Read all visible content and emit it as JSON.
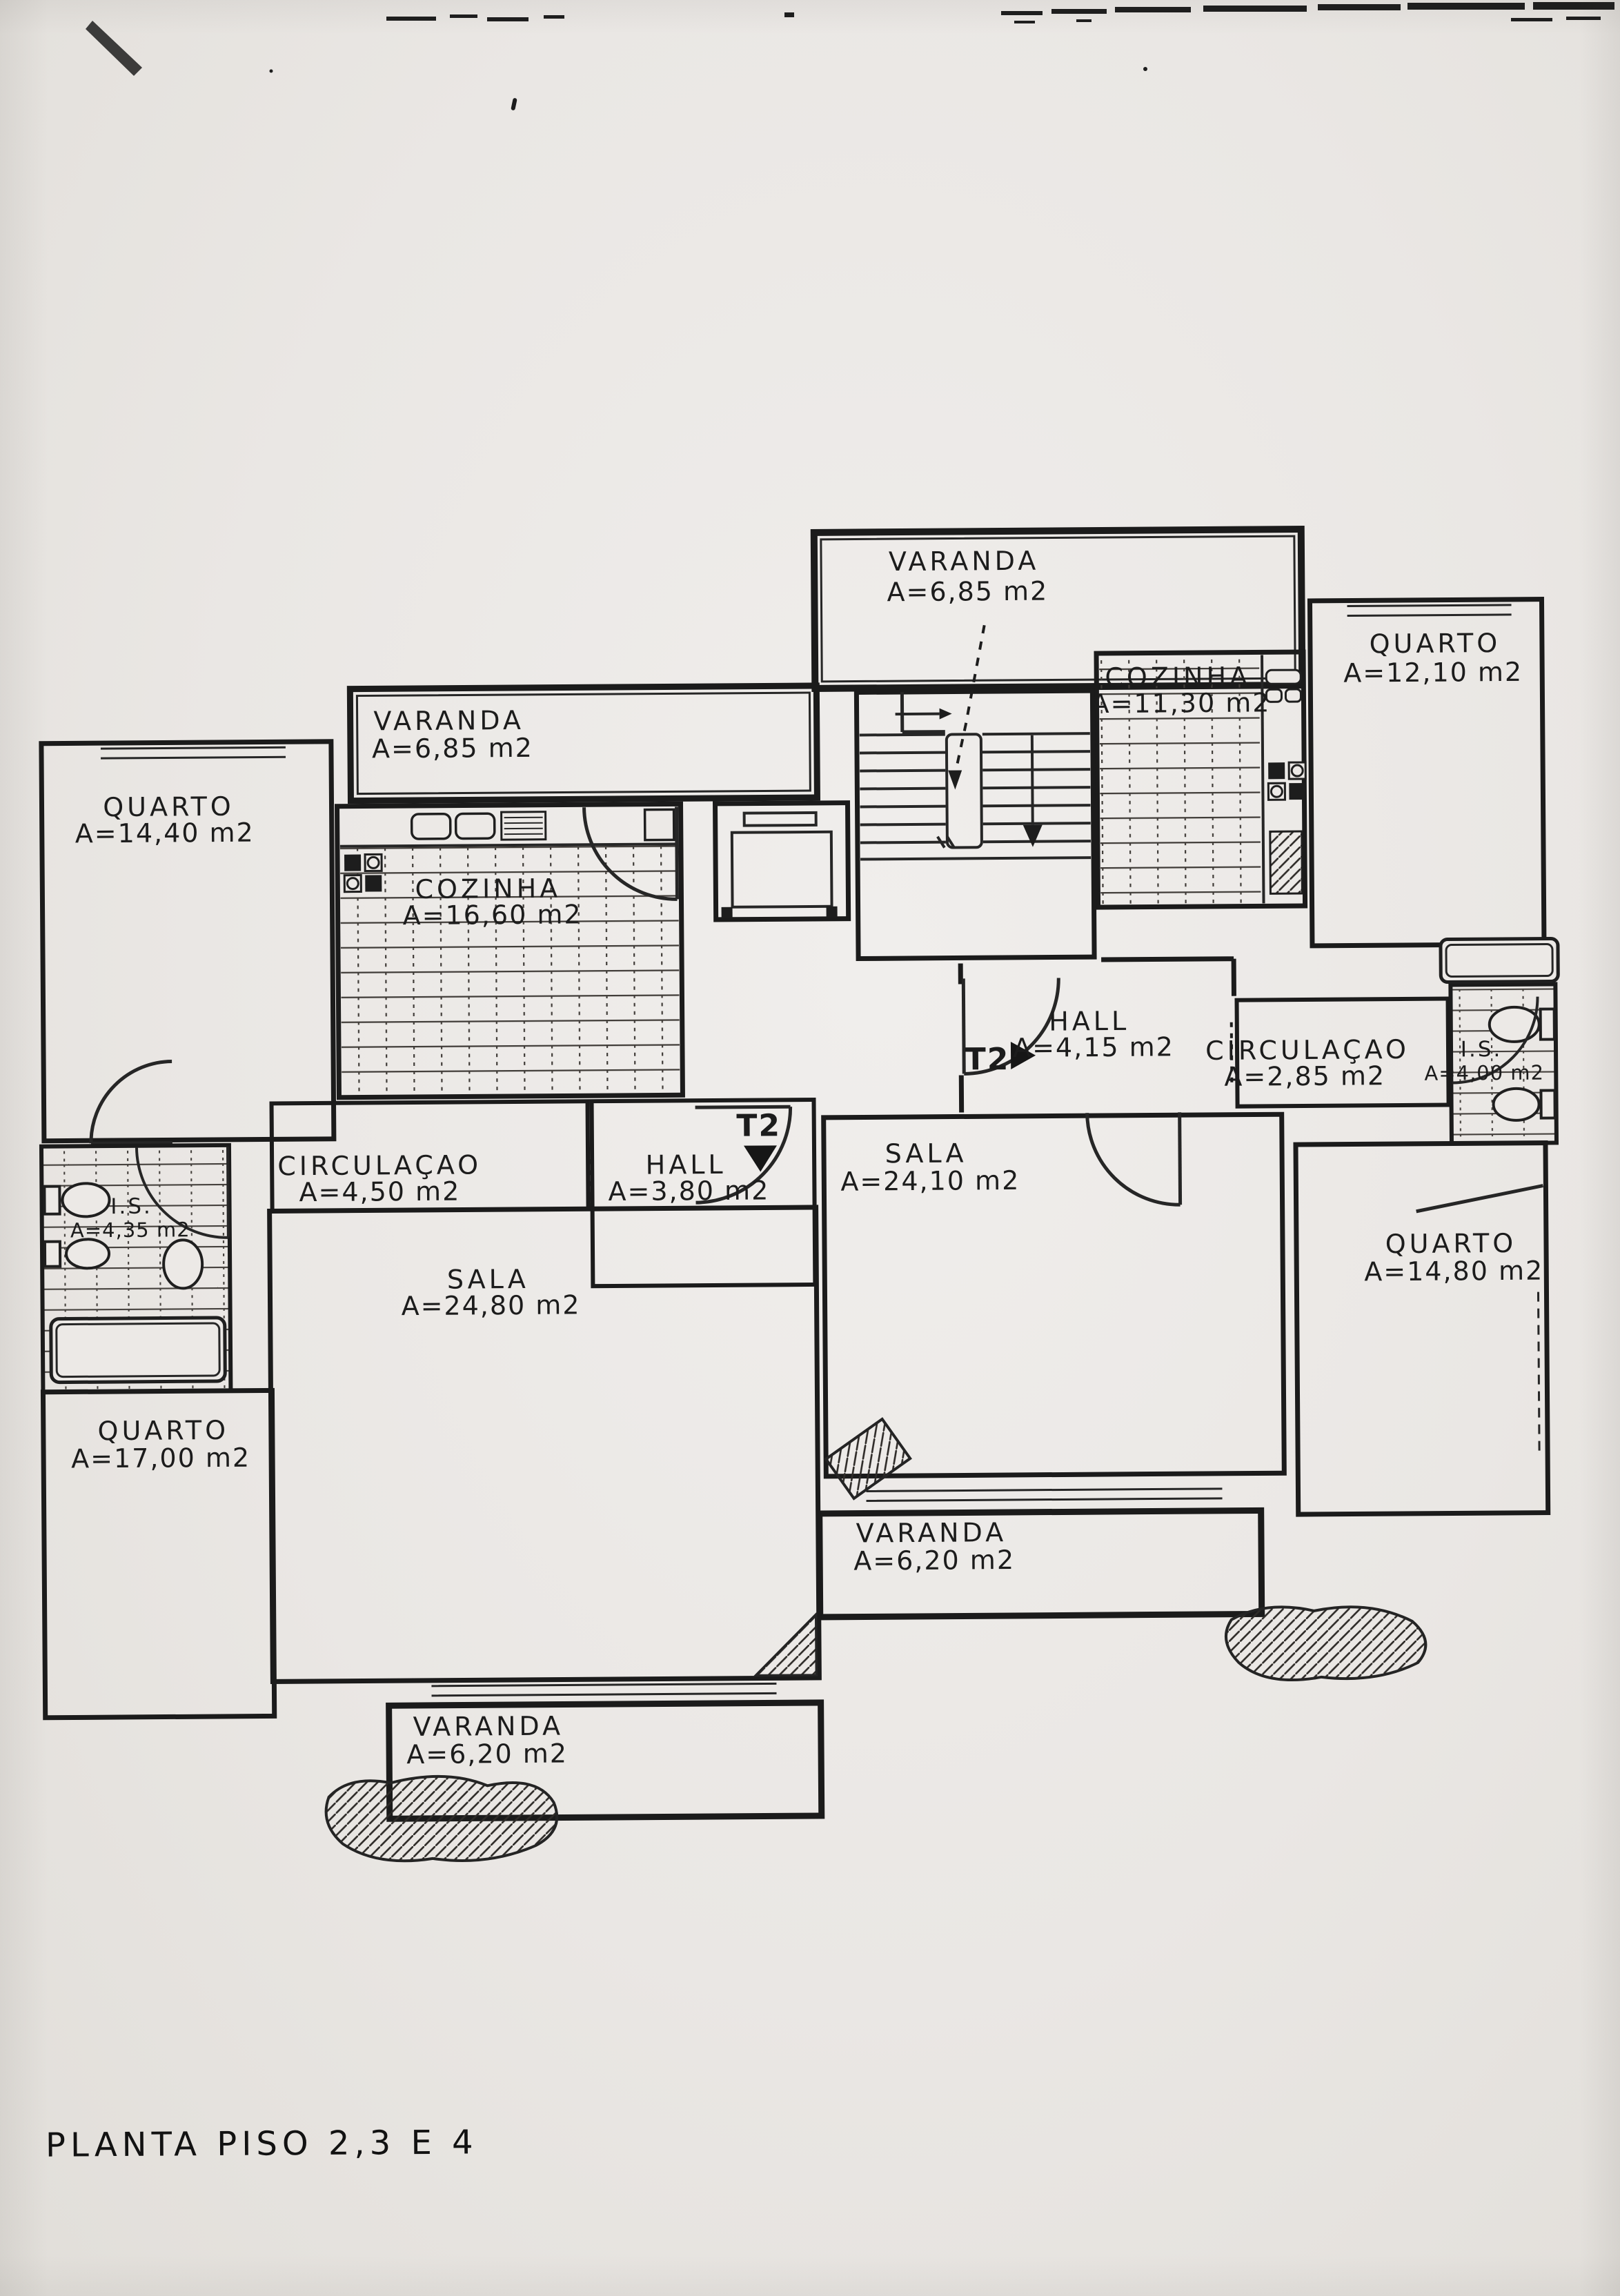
{
  "title": {
    "text": "PLANTA PISO 2,3 E 4"
  },
  "colors": {
    "paper": "#eae7e4",
    "ink": "#1b1b1b",
    "tile_line": "#3b3835"
  },
  "markers": {
    "t2_right": {
      "label": "T2",
      "direction": "right"
    },
    "t2_left": {
      "label": "T2",
      "direction": "down"
    }
  },
  "icons": {
    "stairs": "stair-flights-with-direction-arrows",
    "elevator": "elevator-shaft-with-cab",
    "bathtub": "bathtub-outline",
    "toilet": "toilet-oval-with-tank",
    "bidet": "bidet-oval",
    "washbasin": "washbasin-oval",
    "kitchen_sink": "double-sink-with-drainer",
    "stove": "four-burner-stove",
    "entrance_arrow": "filled-triangle",
    "door": "quarter-circle-door-swing"
  },
  "rooms": [
    {
      "id": "varanda-top-right",
      "name": "VARANDA",
      "area": "A=6,85 m2"
    },
    {
      "id": "quarto-top-right",
      "name": "QUARTO",
      "area": "A=12,10 m2"
    },
    {
      "id": "cozinha-right",
      "name": "COZINHA",
      "area": "A=11,30 m2"
    },
    {
      "id": "hall-right",
      "name": "HALL",
      "area": "A=4,15 m2"
    },
    {
      "id": "circulacao-right",
      "name": "CIRCULAÇAO",
      "area": "A=2,85 m2"
    },
    {
      "id": "is-right",
      "name": "I.S.",
      "area": "A=4,00 m2"
    },
    {
      "id": "sala-right",
      "name": "SALA",
      "area": "A=24,10 m2"
    },
    {
      "id": "quarto-right",
      "name": "QUARTO",
      "area": "A=14,80 m2"
    },
    {
      "id": "varanda-bottom-mid",
      "name": "VARANDA",
      "area": "A=6,20 m2"
    },
    {
      "id": "varanda-left",
      "name": "VARANDA",
      "area": "A=6,85 m2"
    },
    {
      "id": "quarto-top-left",
      "name": "QUARTO",
      "area": "A=14,40 m2"
    },
    {
      "id": "cozinha-left",
      "name": "COZINHA",
      "area": "A=16,60 m2"
    },
    {
      "id": "circulacao-left",
      "name": "CIRCULAÇAO",
      "area": "A=4,50 m2"
    },
    {
      "id": "hall-left",
      "name": "HALL",
      "area": "A=3,80 m2"
    },
    {
      "id": "is-left",
      "name": "I.S.",
      "area": "A=4,35 m2"
    },
    {
      "id": "sala-left",
      "name": "SALA",
      "area": "A=24,80 m2"
    },
    {
      "id": "quarto-bottom-left",
      "name": "QUARTO",
      "area": "A=17,00 m2"
    },
    {
      "id": "varanda-bottom-left",
      "name": "VARANDA",
      "area": "A=6,20 m2"
    }
  ]
}
